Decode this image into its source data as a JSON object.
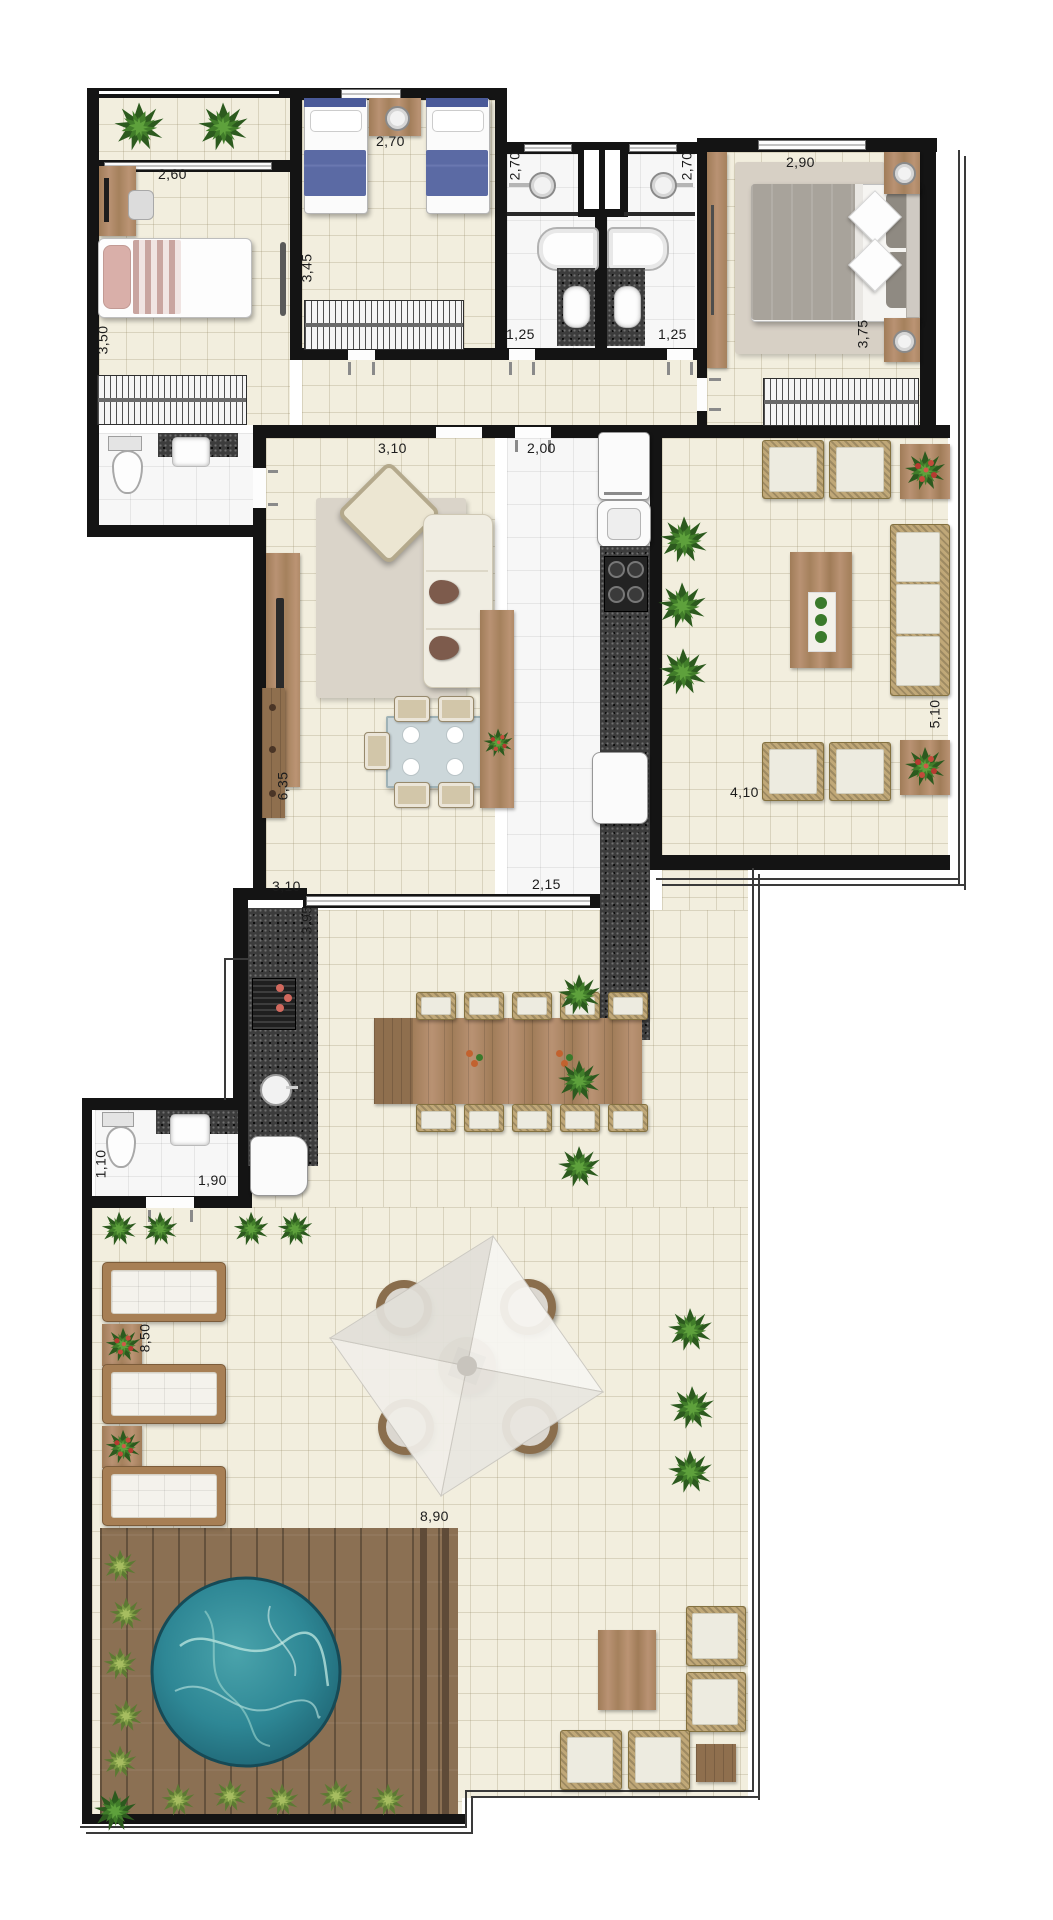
{
  "colors": {
    "wall": "#141414",
    "floor_indoor": "#f2eede",
    "floor_tile": "#f7f7f7",
    "wood": "#a5815d",
    "granite": "#3c3c3c",
    "pool_water": "#2e8795",
    "deck": "#8b7053",
    "plant_green": "#417d2a",
    "bed_blue": "#52619b",
    "cushion": "#edebe0"
  },
  "dims": [
    {
      "id": "bedroom1-width",
      "t": "2,60"
    },
    {
      "id": "bedroom1-depth",
      "t": "3,50"
    },
    {
      "id": "bedroom2-width",
      "t": "2,70"
    },
    {
      "id": "bedroom2-depth",
      "t": "3,45"
    },
    {
      "id": "bathroom1-depth",
      "t": "2,70"
    },
    {
      "id": "bathroom2-depth",
      "t": "2,70"
    },
    {
      "id": "bathroom1-width",
      "t": "1,25"
    },
    {
      "id": "bathroom2-width",
      "t": "1,25"
    },
    {
      "id": "master-bedroom-width",
      "t": "2,90"
    },
    {
      "id": "master-bedroom-depth",
      "t": "3,75"
    },
    {
      "id": "living-width-top",
      "t": "3,10"
    },
    {
      "id": "kitchen-width",
      "t": "2,00"
    },
    {
      "id": "side-terrace-depth",
      "t": "5,10"
    },
    {
      "id": "side-terrace-width",
      "t": "4,10"
    },
    {
      "id": "living-depth",
      "t": "6,35"
    },
    {
      "id": "living-width-bottom",
      "t": "3,10"
    },
    {
      "id": "kitchen-width-bottom",
      "t": "2,15"
    },
    {
      "id": "gourmet-terrace-depth",
      "t": "3,95"
    },
    {
      "id": "wc-width",
      "t": "1,10"
    },
    {
      "id": "wc-depth",
      "t": "1,90"
    },
    {
      "id": "pool-terrace-depth",
      "t": "8,50"
    },
    {
      "id": "pool-terrace-width",
      "t": "8,90"
    }
  ]
}
